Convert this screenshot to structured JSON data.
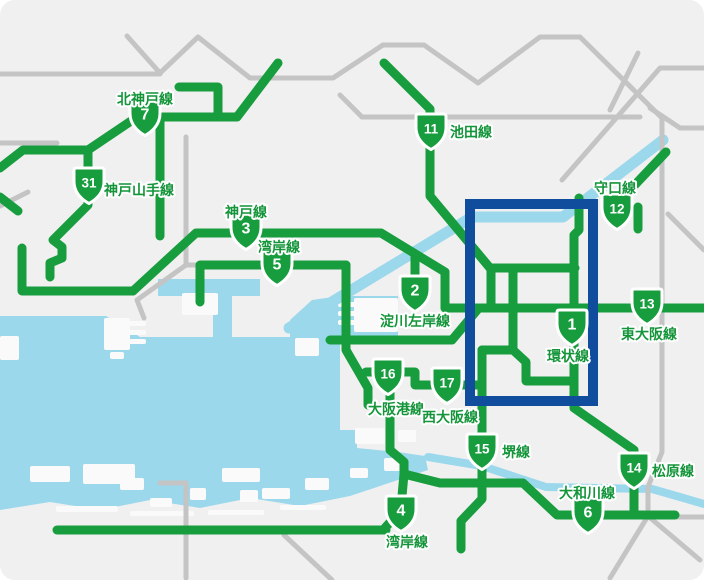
{
  "colors": {
    "land": "#f0f0f0",
    "water": "#9bd8ec",
    "road": "#c4c4c4",
    "route_green": "#179c3e",
    "badge_fill": "#179c3e",
    "badge_border": "#ffffff",
    "label_green": "#14953a",
    "highlight_blue": "#104e9d",
    "island_white": "#fafafa"
  },
  "highlight_rect": {
    "x": 470,
    "y": 204,
    "width": 123,
    "height": 197,
    "stroke_width": 10
  },
  "routes": [
    {
      "number": "1",
      "name": "環状線",
      "badge": {
        "x": 572,
        "y": 327
      },
      "label": {
        "x": 568,
        "y": 356,
        "anchor": "middle"
      }
    },
    {
      "number": "2",
      "name": "淀川左岸線",
      "badge": {
        "x": 415,
        "y": 293
      },
      "label": {
        "x": 415,
        "y": 321,
        "anchor": "middle"
      }
    },
    {
      "number": "3",
      "name": "神戸線",
      "badge": {
        "x": 246,
        "y": 231
      },
      "label": {
        "x": 246,
        "y": 212,
        "anchor": "middle"
      }
    },
    {
      "number": "4",
      "name": "湾岸線",
      "badge": {
        "x": 401,
        "y": 513
      },
      "label": {
        "x": 407,
        "y": 542,
        "anchor": "middle"
      }
    },
    {
      "number": "5",
      "name": "湾岸線",
      "badge": {
        "x": 277,
        "y": 267
      },
      "label": {
        "x": 279,
        "y": 247,
        "anchor": "middle"
      }
    },
    {
      "number": "6",
      "name": "大和川線",
      "badge": {
        "x": 588,
        "y": 515
      },
      "label": {
        "x": 587,
        "y": 493,
        "anchor": "middle"
      }
    },
    {
      "number": "7",
      "name": "北神戸線",
      "badge": {
        "x": 145,
        "y": 117
      },
      "label": {
        "x": 145,
        "y": 99,
        "anchor": "middle"
      }
    },
    {
      "number": "11",
      "name": "池田線",
      "badge": {
        "x": 431,
        "y": 131
      },
      "label": {
        "x": 450,
        "y": 132,
        "anchor": "start"
      }
    },
    {
      "number": "12",
      "name": "守口線",
      "badge": {
        "x": 617,
        "y": 211
      },
      "label": {
        "x": 615,
        "y": 188,
        "anchor": "middle"
      }
    },
    {
      "number": "13",
      "name": "東大阪線",
      "badge": {
        "x": 647,
        "y": 306
      },
      "label": {
        "x": 649,
        "y": 334,
        "anchor": "middle"
      }
    },
    {
      "number": "14",
      "name": "松原線",
      "badge": {
        "x": 634,
        "y": 470
      },
      "label": {
        "x": 652,
        "y": 471,
        "anchor": "start"
      }
    },
    {
      "number": "15",
      "name": "堺線",
      "badge": {
        "x": 482,
        "y": 451
      },
      "label": {
        "x": 502,
        "y": 452,
        "anchor": "start"
      }
    },
    {
      "number": "16",
      "name": "大阪港線",
      "badge": {
        "x": 388,
        "y": 376
      },
      "label": {
        "x": 396,
        "y": 409,
        "anchor": "middle"
      }
    },
    {
      "number": "17",
      "name": "西大阪線",
      "badge": {
        "x": 447,
        "y": 385
      },
      "label": {
        "x": 450,
        "y": 417,
        "anchor": "middle"
      }
    },
    {
      "number": "31",
      "name": "神戸山手線",
      "badge": {
        "x": 89,
        "y": 185
      },
      "label": {
        "x": 104,
        "y": 190,
        "anchor": "start"
      }
    }
  ],
  "network": {
    "green_width": 9,
    "road_width": 5,
    "green_lines": [
      [
        [
          137,
          117
        ],
        [
          237,
          117
        ],
        [
          278,
          63
        ]
      ],
      [
        [
          179,
          87
        ],
        [
          218,
          87
        ],
        [
          218,
          113
        ]
      ],
      [
        [
          160,
          117
        ],
        [
          160,
          236
        ]
      ],
      [
        [
          137,
          117
        ],
        [
          88,
          150
        ]
      ],
      [
        [
          0,
          168
        ],
        [
          23,
          150
        ],
        [
          88,
          150
        ]
      ],
      [
        [
          88,
          150
        ],
        [
          88,
          205
        ],
        [
          53,
          240
        ],
        [
          62,
          247
        ],
        [
          62,
          258
        ],
        [
          50,
          263
        ],
        [
          50,
          277
        ]
      ],
      [
        [
          0,
          197
        ],
        [
          18,
          211
        ]
      ],
      [
        [
          22,
          248
        ],
        [
          22,
          291
        ],
        [
          133,
          291
        ]
      ],
      [
        [
          133,
          291
        ],
        [
          196,
          233
        ],
        [
          381,
          233
        ],
        [
          445,
          272
        ],
        [
          445,
          308
        ]
      ],
      [
        [
          445,
          308
        ],
        [
          704,
          308
        ]
      ],
      [
        [
          415,
          256
        ],
        [
          415,
          281
        ]
      ],
      [
        [
          384,
          63
        ],
        [
          430,
          109
        ],
        [
          430,
          196
        ],
        [
          490,
          268
        ]
      ],
      [
        [
          490,
          268
        ],
        [
          575,
          268
        ]
      ],
      [
        [
          491,
          268
        ],
        [
          491,
          308
        ]
      ],
      [
        [
          513,
          268
        ],
        [
          513,
          350
        ]
      ],
      [
        [
          482,
          350
        ],
        [
          513,
          350
        ],
        [
          526,
          362
        ],
        [
          526,
          381
        ],
        [
          574,
          381
        ]
      ],
      [
        [
          579,
          198
        ],
        [
          579,
          230
        ],
        [
          574,
          235
        ],
        [
          574,
          408
        ],
        [
          634,
          450
        ],
        [
          634,
          515
        ]
      ],
      [
        [
          612,
          207
        ],
        [
          612,
          199
        ],
        [
          630,
          190
        ],
        [
          666,
          152
        ]
      ],
      [
        [
          638,
          207
        ],
        [
          638,
          229
        ]
      ],
      [
        [
          404,
          474
        ],
        [
          440,
          483
        ],
        [
          523,
          483
        ],
        [
          557,
          515
        ],
        [
          675,
          515
        ]
      ],
      [
        [
          482,
          350
        ],
        [
          482,
          499
        ],
        [
          461,
          521
        ],
        [
          461,
          549
        ]
      ],
      [
        [
          366,
          372
        ],
        [
          415,
          372
        ],
        [
          415,
          385
        ],
        [
          482,
          385
        ]
      ],
      [
        [
          346,
          265
        ],
        [
          346,
          350
        ],
        [
          368,
          388
        ],
        [
          368,
          405
        ]
      ],
      [
        [
          330,
          340
        ],
        [
          452,
          340
        ],
        [
          478,
          309
        ]
      ],
      [
        [
          200,
          302
        ],
        [
          200,
          265
        ],
        [
          346,
          265
        ]
      ],
      [
        [
          390,
          372
        ],
        [
          390,
          450
        ],
        [
          404,
          462
        ],
        [
          404,
          474
        ]
      ],
      [
        [
          404,
          474
        ],
        [
          402,
          496
        ],
        [
          393,
          519
        ],
        [
          384,
          529
        ]
      ],
      [
        [
          57,
          530
        ],
        [
          386,
          530
        ]
      ]
    ],
    "gray_roads": [
      [
        [
          0,
          74
        ],
        [
          160,
          74
        ]
      ],
      [
        [
          127,
          36
        ],
        [
          160,
          73
        ]
      ],
      [
        [
          160,
          73
        ],
        [
          198,
          37
        ],
        [
          250,
          78
        ],
        [
          333,
          78
        ],
        [
          383,
          45
        ],
        [
          424,
          45
        ],
        [
          478,
          83
        ],
        [
          540,
          37
        ],
        [
          580,
          37
        ],
        [
          662,
          118
        ],
        [
          662,
          452
        ],
        [
          648,
          487
        ],
        [
          648,
          516
        ]
      ],
      [
        [
          362,
          117
        ],
        [
          640,
          117
        ]
      ],
      [
        [
          340,
          95
        ],
        [
          362,
          117
        ]
      ],
      [
        [
          704,
          68
        ],
        [
          660,
          68
        ],
        [
          562,
          180
        ]
      ],
      [
        [
          638,
          53
        ],
        [
          610,
          110
        ]
      ],
      [
        [
          650,
          108
        ],
        [
          680,
          128
        ],
        [
          704,
          128
        ]
      ],
      [
        [
          668,
          214
        ],
        [
          704,
          250
        ]
      ],
      [
        [
          186,
          137
        ],
        [
          186,
          265
        ],
        [
          137,
          300
        ],
        [
          144,
          318
        ]
      ],
      [
        [
          186,
          265
        ],
        [
          196,
          265
        ]
      ],
      [
        [
          0,
          143
        ],
        [
          57,
          143
        ]
      ],
      [
        [
          0,
          206
        ],
        [
          28,
          192
        ]
      ],
      [
        [
          160,
          483
        ],
        [
          186,
          483
        ],
        [
          186,
          578
        ]
      ],
      [
        [
          284,
          535
        ],
        [
          332,
          580
        ]
      ],
      [
        [
          648,
          516
        ],
        [
          610,
          578
        ]
      ],
      [
        [
          648,
          516
        ],
        [
          700,
          560
        ]
      ],
      [
        [
          676,
          517
        ],
        [
          704,
          517
        ]
      ]
    ],
    "rivers": [
      {
        "points": [
          [
            289,
            328
          ],
          [
            472,
            217
          ],
          [
            563,
            217
          ],
          [
            663,
            140
          ]
        ],
        "width": 11
      },
      {
        "points": [
          [
            428,
            457
          ],
          [
            482,
            466
          ],
          [
            546,
            487
          ],
          [
            652,
            489
          ],
          [
            680,
            497
          ],
          [
            704,
            504
          ]
        ],
        "width": 8
      }
    ],
    "bay_polygon": [
      [
        0,
        316
      ],
      [
        106,
        316
      ],
      [
        140,
        337
      ],
      [
        213,
        337
      ],
      [
        213,
        295
      ],
      [
        232,
        295
      ],
      [
        232,
        337
      ],
      [
        290,
        337
      ],
      [
        290,
        320
      ],
      [
        312,
        300
      ],
      [
        340,
        296
      ],
      [
        398,
        296
      ],
      [
        398,
        340
      ],
      [
        340,
        340
      ],
      [
        340,
        430
      ],
      [
        357,
        430
      ],
      [
        357,
        448
      ],
      [
        398,
        452
      ],
      [
        425,
        456
      ],
      [
        428,
        470
      ],
      [
        398,
        480
      ],
      [
        350,
        496
      ],
      [
        300,
        506
      ],
      [
        250,
        498
      ],
      [
        200,
        508
      ],
      [
        150,
        500
      ],
      [
        100,
        510
      ],
      [
        50,
        502
      ],
      [
        0,
        510
      ]
    ],
    "water_rects": [
      [
        158,
        279,
        102,
        17
      ]
    ],
    "islands": [
      [
        182,
        293,
        36,
        22
      ],
      [
        104,
        318,
        26,
        32
      ],
      [
        128,
        321,
        18,
        5
      ],
      [
        128,
        330,
        18,
        5
      ],
      [
        128,
        339,
        18,
        5
      ],
      [
        110,
        352,
        14,
        7
      ],
      [
        0,
        336,
        19,
        24
      ],
      [
        295,
        338,
        24,
        18
      ],
      [
        354,
        298,
        44,
        34
      ],
      [
        338,
        302,
        18,
        5
      ],
      [
        338,
        311,
        18,
        5
      ],
      [
        338,
        320,
        18,
        5
      ],
      [
        83,
        464,
        52,
        20
      ],
      [
        30,
        466,
        40,
        16
      ],
      [
        120,
        478,
        24,
        12
      ],
      [
        150,
        498,
        22,
        9
      ],
      [
        190,
        488,
        16,
        12
      ],
      [
        240,
        490,
        18,
        12
      ],
      [
        222,
        468,
        38,
        14
      ],
      [
        262,
        488,
        28,
        11
      ],
      [
        305,
        478,
        24,
        12
      ],
      [
        355,
        428,
        30,
        16
      ],
      [
        384,
        458,
        22,
        13
      ],
      [
        398,
        430,
        18,
        12
      ],
      [
        350,
        468,
        18,
        10
      ],
      [
        56,
        506,
        62,
        6
      ],
      [
        130,
        511,
        64,
        5
      ],
      [
        208,
        510,
        56,
        5
      ],
      [
        280,
        505,
        46,
        5
      ]
    ]
  }
}
